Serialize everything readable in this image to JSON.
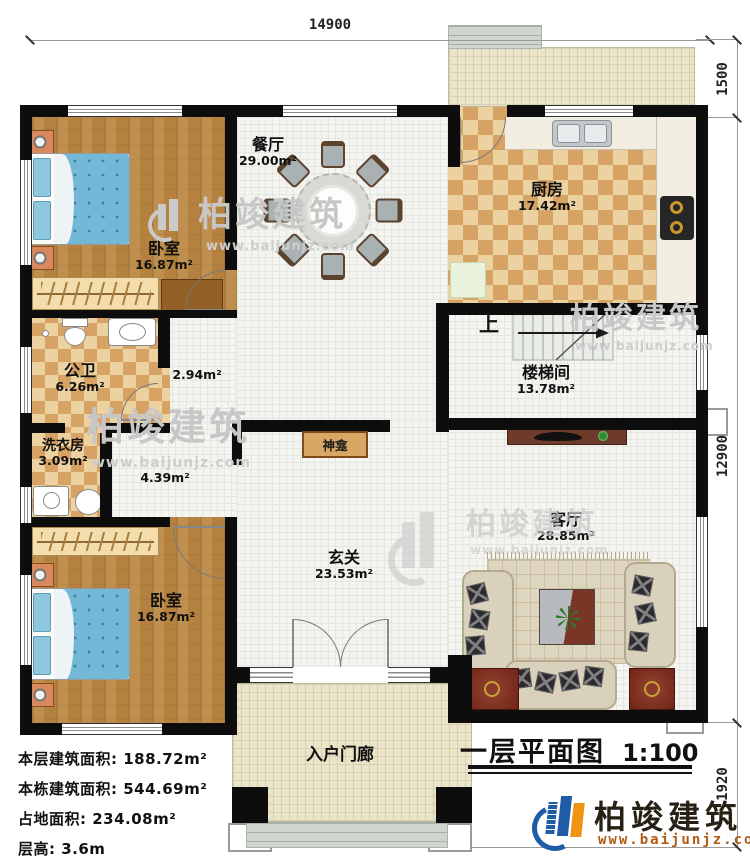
{
  "title": {
    "main": "一层平面图",
    "scale": "1:100"
  },
  "dimensions": {
    "top": "14900",
    "right_top": "1500",
    "right_middle": "12900",
    "right_bottom": "1920"
  },
  "rooms": {
    "dining": {
      "name": "餐厅",
      "area": "29.00m²"
    },
    "kitchen": {
      "name": "厨房",
      "area": "17.42m²"
    },
    "bedroom_top": {
      "name": "卧室",
      "area": "16.87m²"
    },
    "bedroom_bottom": {
      "name": "卧室",
      "area": "16.87m²"
    },
    "bathroom": {
      "name": "公卫",
      "area": "6.26m²"
    },
    "hall": {
      "area": "2.94m²"
    },
    "laundry": {
      "name": "洗衣房",
      "area": "3.09m²"
    },
    "corridor": {
      "area": "4.39m²"
    },
    "stairwell": {
      "name": "楼梯间",
      "area": "13.78m²"
    },
    "foyer": {
      "name": "玄关",
      "area": "23.53m²"
    },
    "living": {
      "name": "客厅",
      "area": "28.85m²"
    },
    "porch": {
      "name": "入户门廊"
    },
    "shrine": {
      "name": "神龛"
    },
    "stairs_up_label": "上"
  },
  "info": {
    "lines": [
      {
        "label": "本层建筑面积:",
        "value": "188.72m²"
      },
      {
        "label": "本栋建筑面积:",
        "value": "544.69m²"
      },
      {
        "label": "占地面积:",
        "value": "234.08m²"
      },
      {
        "label": "层高:",
        "value": "3.6m"
      }
    ]
  },
  "brand": {
    "name": "柏竣建筑",
    "url": "www.baijunjz.com"
  },
  "watermark": {
    "text": "柏竣建筑",
    "url": "www.baijunjz.com"
  }
}
